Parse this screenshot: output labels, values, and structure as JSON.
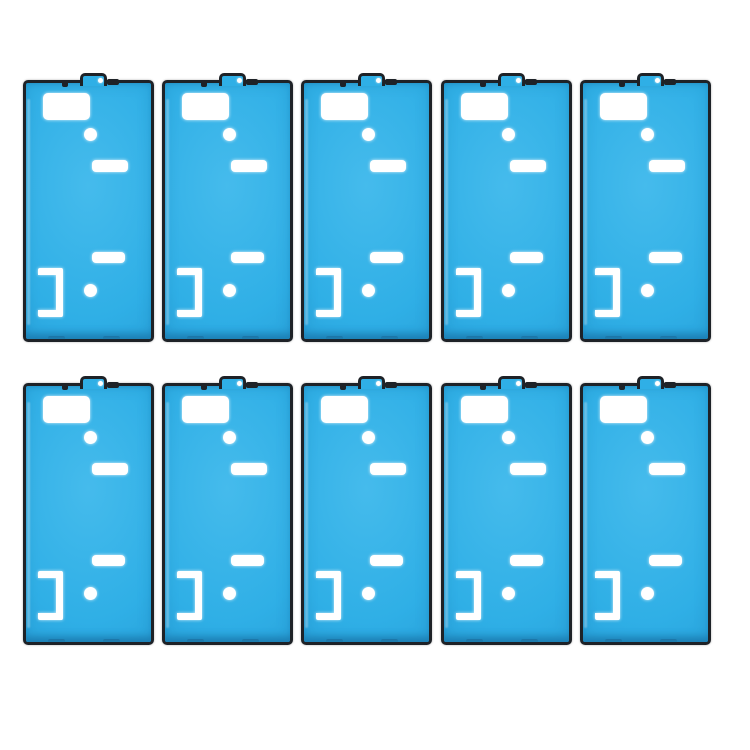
{
  "scene": {
    "background": "#ffffff",
    "width": 750,
    "height": 750,
    "item_count": 10
  },
  "colors": {
    "background": "#ffffff",
    "frame": "#1e2227",
    "blue": "#2fafe6",
    "blue_light": "#45bbec",
    "blue_dark": "#2598d2",
    "blue_deep": "#1c7fb4",
    "cutout": "#ffffff"
  },
  "grid": {
    "column_lefts": [
      23,
      162,
      301,
      441,
      580
    ],
    "row_tops": [
      80,
      383
    ],
    "sticker_width": 131,
    "sticker_height": 262
  },
  "sticker_parts": {
    "pull_tab": {
      "left": 54,
      "top": -10,
      "width": 21,
      "height": 10
    },
    "window_rect": {
      "left": 17,
      "top": 10,
      "width": 47,
      "height": 27
    },
    "hole_upper": {
      "left": 58,
      "top": 45,
      "width": 13,
      "height": 13
    },
    "slot_upper": {
      "left": 66,
      "top": 77,
      "width": 36,
      "height": 12
    },
    "slot_lower": {
      "left": 66,
      "top": 169,
      "width": 33,
      "height": 11
    },
    "bracket": {
      "left": 12,
      "top": 185,
      "width": 25,
      "height": 49
    },
    "hole_lower": {
      "left": 58,
      "top": 201,
      "width": 13,
      "height": 13
    }
  }
}
